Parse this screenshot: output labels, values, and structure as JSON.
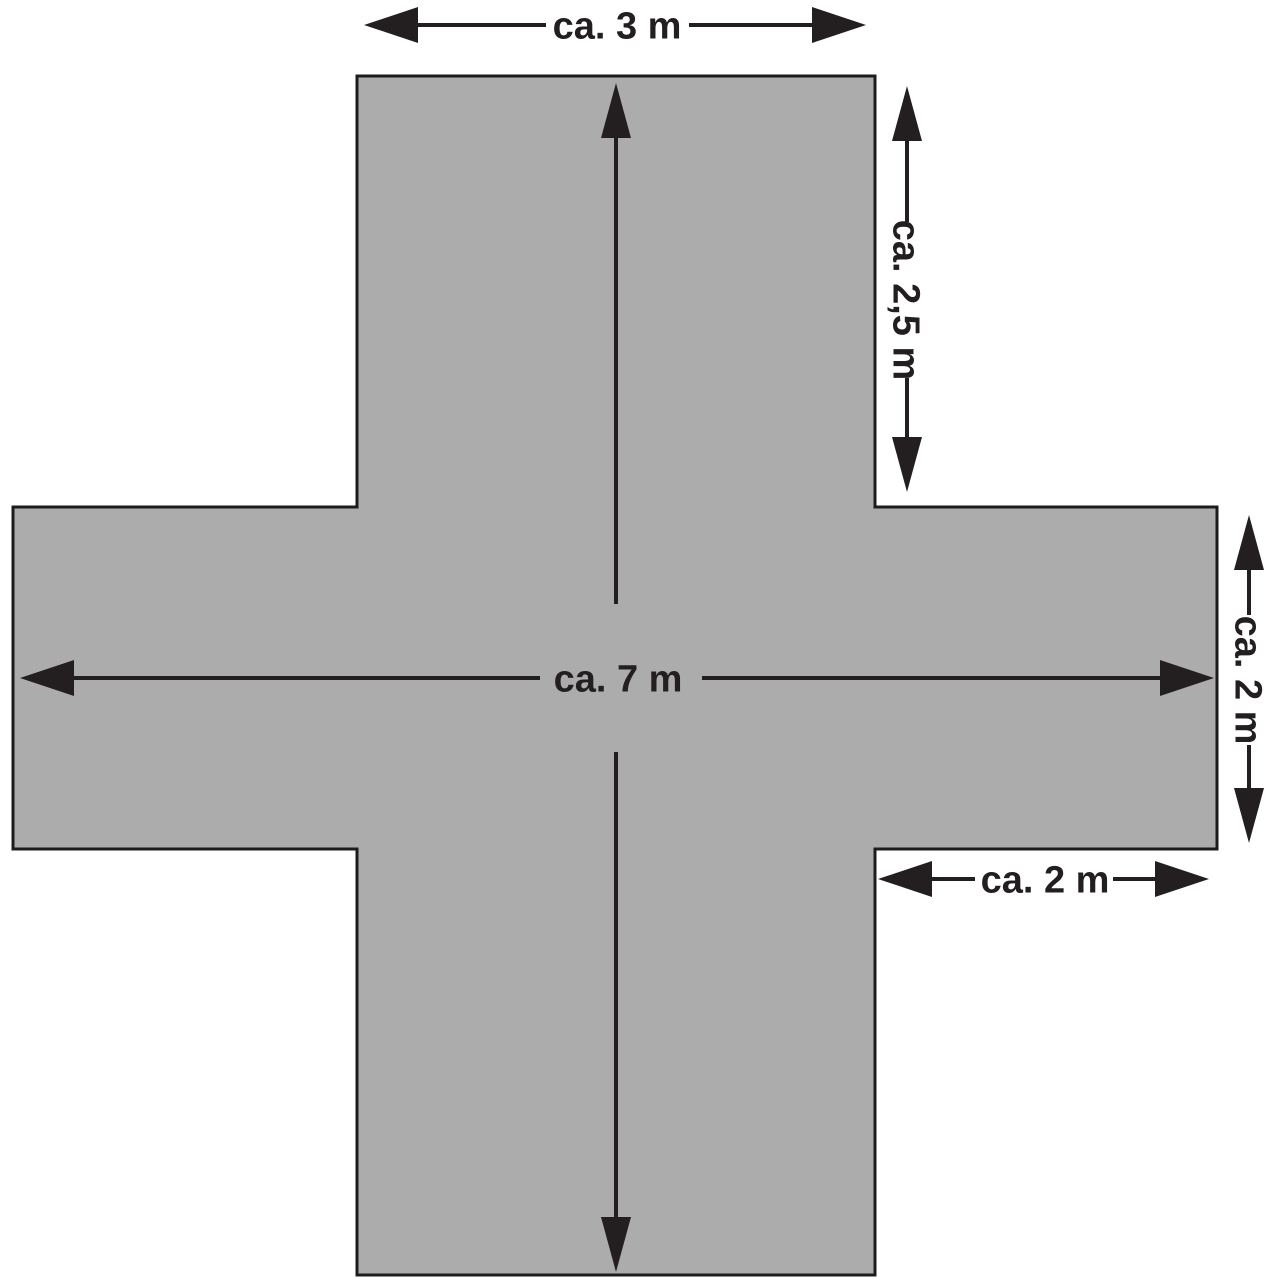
{
  "diagram": {
    "type": "dimensioned-floor-plan",
    "shape": "cross",
    "colors": {
      "shape_fill": "#acacac",
      "shape_stroke": "#1c1c1c",
      "annotation": "#231f20",
      "background": "#ffffff"
    },
    "labels": {
      "top_width": "ca. 3 m",
      "top_arm_height": "ca. 2,5 m",
      "total_span": "ca. 7 m",
      "right_arm_height": "ca. 2 m",
      "right_arm_width": "ca. 2 m"
    },
    "dimensions": [
      {
        "name": "top-width",
        "label": "ca. 3 m",
        "meters": 3,
        "orientation": "horizontal"
      },
      {
        "name": "top-arm-height",
        "label": "ca. 2,5 m",
        "meters": 2.5,
        "orientation": "vertical"
      },
      {
        "name": "total-span",
        "label": "ca. 7 m",
        "meters": 7,
        "orientation": "horizontal and vertical"
      },
      {
        "name": "right-arm-height",
        "label": "ca. 2 m",
        "meters": 2,
        "orientation": "vertical"
      },
      {
        "name": "right-arm-width",
        "label": "ca. 2 m",
        "meters": 2,
        "orientation": "horizontal"
      }
    ]
  }
}
